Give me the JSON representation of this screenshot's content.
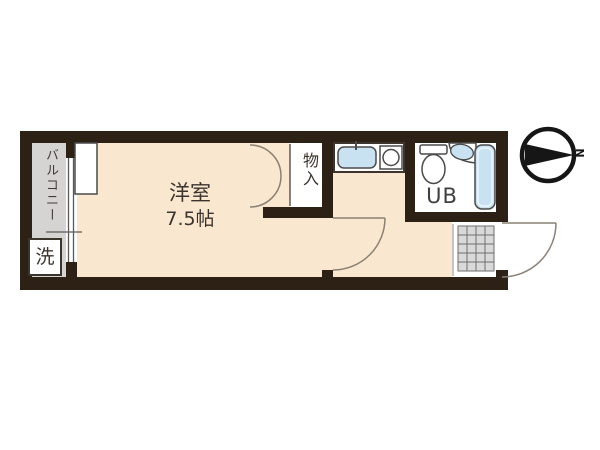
{
  "plan": {
    "balcony_label": "バルコニー",
    "washer_label": "洗",
    "room_label": "洋室",
    "room_size": "7.5帖",
    "closet_label": "物入",
    "bath_label": "UB",
    "compass_north": "N"
  },
  "colors": {
    "wall": "#2d2014",
    "floor": "#f9e7cf",
    "balcony": "#d5d4d2",
    "tile": "#d9d9d9",
    "tile_line": "#6e6e6e",
    "water": "#c9e2f2",
    "fixture_line": "#4a4a4a",
    "door_line": "#8a8075",
    "white": "#ffffff",
    "compass": "#161616"
  }
}
